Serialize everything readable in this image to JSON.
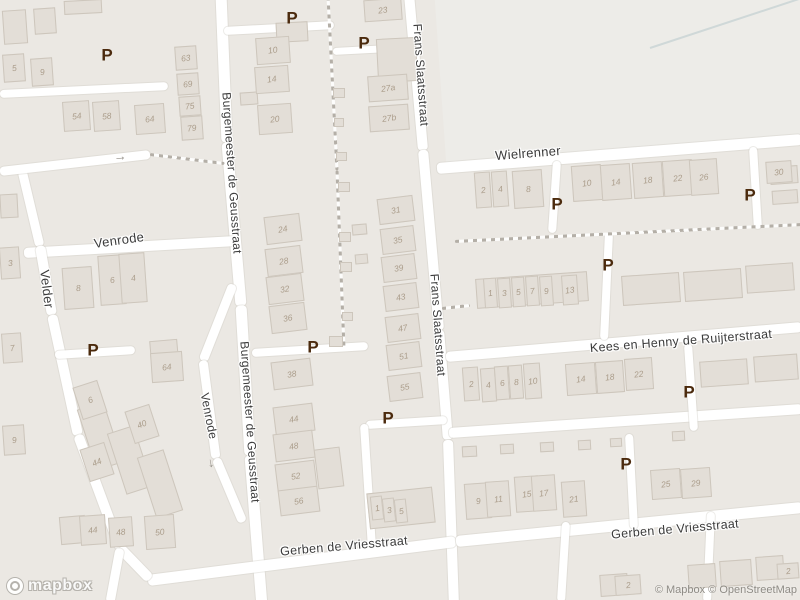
{
  "map": {
    "background": "#ebe8e3",
    "road_color": "#ffffff",
    "building_fill": "#e3ded7",
    "building_border": "#cdc6bc",
    "building_number_color": "#ab9d8b",
    "street_label_color": "#3b3b3b",
    "parking_color": "#4b2a0d",
    "parking_glyph": "P",
    "oneway_arrow_glyph": "→"
  },
  "street_labels": [
    {
      "text": "Frans Slaatsstraat",
      "x": 421,
      "y": 75,
      "rot": 86,
      "size": 12
    },
    {
      "text": "Frans Slaatsstraat",
      "x": 438,
      "y": 325,
      "rot": 86,
      "size": 12
    },
    {
      "text": "Burgemeester de Geusstraat",
      "x": 232,
      "y": 173,
      "rot": 86,
      "size": 12
    },
    {
      "text": "Burgemeester de Geusstraat",
      "x": 250,
      "y": 422,
      "rot": 86,
      "size": 12
    },
    {
      "text": "Wielrenner",
      "x": 528,
      "y": 153,
      "rot": -4.5,
      "size": 13
    },
    {
      "text": "Venrode",
      "x": 119,
      "y": 240,
      "rot": -8,
      "size": 13
    },
    {
      "text": "Velder",
      "x": 47,
      "y": 289,
      "rot": 83,
      "size": 13
    },
    {
      "text": "Venrode",
      "x": 209,
      "y": 416,
      "rot": 79,
      "size": 12
    },
    {
      "text": "Kees en Henny de Ruijterstraat",
      "x": 681,
      "y": 341,
      "rot": -4.5,
      "size": 12.5
    },
    {
      "text": "Gerben de Vriesstraat",
      "x": 344,
      "y": 546,
      "rot": -5,
      "size": 12.5
    },
    {
      "text": "Gerben de Vriesstraat",
      "x": 675,
      "y": 529,
      "rot": -5,
      "size": 12.5
    }
  ],
  "parking_markers": [
    {
      "x": 107,
      "y": 55
    },
    {
      "x": 292,
      "y": 18
    },
    {
      "x": 364,
      "y": 43
    },
    {
      "x": 557,
      "y": 204
    },
    {
      "x": 750,
      "y": 195
    },
    {
      "x": 608,
      "y": 265
    },
    {
      "x": 93,
      "y": 350
    },
    {
      "x": 313,
      "y": 347
    },
    {
      "x": 388,
      "y": 418
    },
    {
      "x": 689,
      "y": 392
    },
    {
      "x": 626,
      "y": 464
    }
  ],
  "arrows": [
    {
      "x": 120,
      "y": 156,
      "rot": -6
    },
    {
      "x": 213,
      "y": 463,
      "rot": 80
    }
  ],
  "buildings": [
    {
      "n": "5",
      "x": 14,
      "y": 68,
      "w": 22,
      "h": 28
    },
    {
      "n": "9",
      "x": 42,
      "y": 72,
      "w": 22,
      "h": 28
    },
    {
      "n": "54",
      "x": 76,
      "y": 116,
      "w": 27,
      "h": 30
    },
    {
      "n": "58",
      "x": 106,
      "y": 116,
      "w": 27,
      "h": 30
    },
    {
      "n": "64",
      "x": 150,
      "y": 119,
      "w": 30,
      "h": 30
    },
    {
      "n": "63",
      "x": 186,
      "y": 58,
      "w": 22,
      "h": 24
    },
    {
      "n": "69",
      "x": 188,
      "y": 84,
      "w": 22,
      "h": 22
    },
    {
      "n": "75",
      "x": 190,
      "y": 106,
      "w": 22,
      "h": 20
    },
    {
      "n": "79",
      "x": 192,
      "y": 128,
      "w": 22,
      "h": 24
    },
    {
      "n": "10",
      "x": 273,
      "y": 50,
      "w": 34,
      "h": 27
    },
    {
      "n": "14",
      "x": 272,
      "y": 79,
      "w": 34,
      "h": 27
    },
    {
      "n": "20",
      "x": 275,
      "y": 119,
      "w": 34,
      "h": 30
    },
    {
      "n": "23",
      "x": 383,
      "y": 10,
      "w": 38,
      "h": 22
    },
    {
      "n": "27a",
      "x": 388,
      "y": 88,
      "w": 40,
      "h": 26
    },
    {
      "n": "27b",
      "x": 389,
      "y": 118,
      "w": 40,
      "h": 26
    },
    {
      "n": "3",
      "x": 10,
      "y": 263,
      "w": 20,
      "h": 32
    },
    {
      "n": "7",
      "x": 12,
      "y": 348,
      "w": 20,
      "h": 30
    },
    {
      "n": "9",
      "x": 14,
      "y": 440,
      "w": 22,
      "h": 30
    },
    {
      "n": "8",
      "x": 78,
      "y": 288,
      "w": 30,
      "h": 42
    },
    {
      "n": "6",
      "x": 112,
      "y": 280,
      "w": 26,
      "h": 50
    },
    {
      "n": "4",
      "x": 133,
      "y": 278,
      "w": 26,
      "h": 50
    },
    {
      "n": "64",
      "x": 167,
      "y": 367,
      "w": 32,
      "h": 30
    },
    {
      "n": "6",
      "x": 90,
      "y": 400,
      "w": 26,
      "h": 34,
      "rot": -18
    },
    {
      "n": "40",
      "x": 142,
      "y": 424,
      "w": 26,
      "h": 34,
      "rot": -18
    },
    {
      "n": "44",
      "x": 97,
      "y": 462,
      "w": 26,
      "h": 34,
      "rot": -18
    },
    {
      "n": "44",
      "x": 93,
      "y": 530,
      "w": 26,
      "h": 30
    },
    {
      "n": "48",
      "x": 121,
      "y": 532,
      "w": 24,
      "h": 30
    },
    {
      "n": "50",
      "x": 160,
      "y": 532,
      "w": 30,
      "h": 34
    },
    {
      "n": "24",
      "x": 283,
      "y": 229,
      "w": 36,
      "h": 28,
      "rot": -7
    },
    {
      "n": "28",
      "x": 284,
      "y": 261,
      "w": 36,
      "h": 28,
      "rot": -7
    },
    {
      "n": "32",
      "x": 285,
      "y": 289,
      "w": 36,
      "h": 28,
      "rot": -7
    },
    {
      "n": "36",
      "x": 288,
      "y": 318,
      "w": 36,
      "h": 28,
      "rot": -7
    },
    {
      "n": "38",
      "x": 292,
      "y": 374,
      "w": 40,
      "h": 28,
      "rot": -7
    },
    {
      "n": "44",
      "x": 294,
      "y": 419,
      "w": 40,
      "h": 28,
      "rot": -7
    },
    {
      "n": "48",
      "x": 294,
      "y": 446,
      "w": 40,
      "h": 28,
      "rot": -7
    },
    {
      "n": "52",
      "x": 296,
      "y": 476,
      "w": 40,
      "h": 28,
      "rot": -7
    },
    {
      "n": "56",
      "x": 299,
      "y": 501,
      "w": 40,
      "h": 26,
      "rot": -7
    },
    {
      "n": "31",
      "x": 396,
      "y": 210,
      "w": 36,
      "h": 26,
      "rot": -7
    },
    {
      "n": "35",
      "x": 398,
      "y": 240,
      "w": 34,
      "h": 26,
      "rot": -7
    },
    {
      "n": "39",
      "x": 399,
      "y": 268,
      "w": 34,
      "h": 26,
      "rot": -7
    },
    {
      "n": "43",
      "x": 401,
      "y": 297,
      "w": 34,
      "h": 26,
      "rot": -7
    },
    {
      "n": "47",
      "x": 403,
      "y": 328,
      "w": 34,
      "h": 26,
      "rot": -7
    },
    {
      "n": "51",
      "x": 404,
      "y": 356,
      "w": 34,
      "h": 26,
      "rot": -7
    },
    {
      "n": "55",
      "x": 405,
      "y": 387,
      "w": 34,
      "h": 26,
      "rot": -7
    },
    {
      "n": "1",
      "x": 377,
      "y": 508,
      "w": 12,
      "h": 24,
      "rot": -6
    },
    {
      "n": "3",
      "x": 389,
      "y": 510,
      "w": 12,
      "h": 24,
      "rot": -6
    },
    {
      "n": "5",
      "x": 401,
      "y": 511,
      "w": 12,
      "h": 24,
      "rot": -6
    },
    {
      "n": "2",
      "x": 483,
      "y": 190,
      "w": 16,
      "h": 36
    },
    {
      "n": "4",
      "x": 500,
      "y": 189,
      "w": 16,
      "h": 36
    },
    {
      "n": "8",
      "x": 528,
      "y": 189,
      "w": 30,
      "h": 38
    },
    {
      "n": "10",
      "x": 587,
      "y": 183,
      "w": 30,
      "h": 36
    },
    {
      "n": "14",
      "x": 616,
      "y": 182,
      "w": 30,
      "h": 36
    },
    {
      "n": "18",
      "x": 648,
      "y": 180,
      "w": 30,
      "h": 36
    },
    {
      "n": "22",
      "x": 678,
      "y": 178,
      "w": 30,
      "h": 36
    },
    {
      "n": "26",
      "x": 704,
      "y": 177,
      "w": 28,
      "h": 36
    },
    {
      "n": "30",
      "x": 779,
      "y": 172,
      "w": 26,
      "h": 22
    },
    {
      "n": "1",
      "x": 490,
      "y": 293,
      "w": 13,
      "h": 30
    },
    {
      "n": "3",
      "x": 504,
      "y": 293,
      "w": 13,
      "h": 30
    },
    {
      "n": "5",
      "x": 518,
      "y": 292,
      "w": 13,
      "h": 30
    },
    {
      "n": "7",
      "x": 532,
      "y": 291,
      "w": 13,
      "h": 30
    },
    {
      "n": "9",
      "x": 546,
      "y": 291,
      "w": 13,
      "h": 30
    },
    {
      "n": "13",
      "x": 570,
      "y": 290,
      "w": 16,
      "h": 30
    },
    {
      "n": "2",
      "x": 471,
      "y": 384,
      "w": 16,
      "h": 34
    },
    {
      "n": "4",
      "x": 488,
      "y": 385,
      "w": 15,
      "h": 34
    },
    {
      "n": "6",
      "x": 502,
      "y": 383,
      "w": 14,
      "h": 34
    },
    {
      "n": "8",
      "x": 516,
      "y": 382,
      "w": 14,
      "h": 34
    },
    {
      "n": "10",
      "x": 532,
      "y": 381,
      "w": 17,
      "h": 36
    },
    {
      "n": "14",
      "x": 581,
      "y": 379,
      "w": 30,
      "h": 32
    },
    {
      "n": "18",
      "x": 610,
      "y": 377,
      "w": 28,
      "h": 32
    },
    {
      "n": "22",
      "x": 639,
      "y": 374,
      "w": 28,
      "h": 32
    },
    {
      "n": "9",
      "x": 478,
      "y": 501,
      "w": 26,
      "h": 36
    },
    {
      "n": "11",
      "x": 498,
      "y": 499,
      "w": 24,
      "h": 36
    },
    {
      "n": "15",
      "x": 527,
      "y": 494,
      "w": 24,
      "h": 36
    },
    {
      "n": "17",
      "x": 544,
      "y": 493,
      "w": 24,
      "h": 36
    },
    {
      "n": "21",
      "x": 574,
      "y": 499,
      "w": 24,
      "h": 36
    },
    {
      "n": "25",
      "x": 666,
      "y": 484,
      "w": 30,
      "h": 30
    },
    {
      "n": "29",
      "x": 696,
      "y": 483,
      "w": 30,
      "h": 30
    },
    {
      "n": "2",
      "x": 628,
      "y": 585,
      "w": 26,
      "h": 20
    },
    {
      "n": "2",
      "x": 788,
      "y": 571,
      "w": 22,
      "h": 16
    }
  ],
  "logo": {
    "text": "mapbox"
  },
  "attribution": {
    "text": "© Mapbox © OpenStreetMap"
  }
}
